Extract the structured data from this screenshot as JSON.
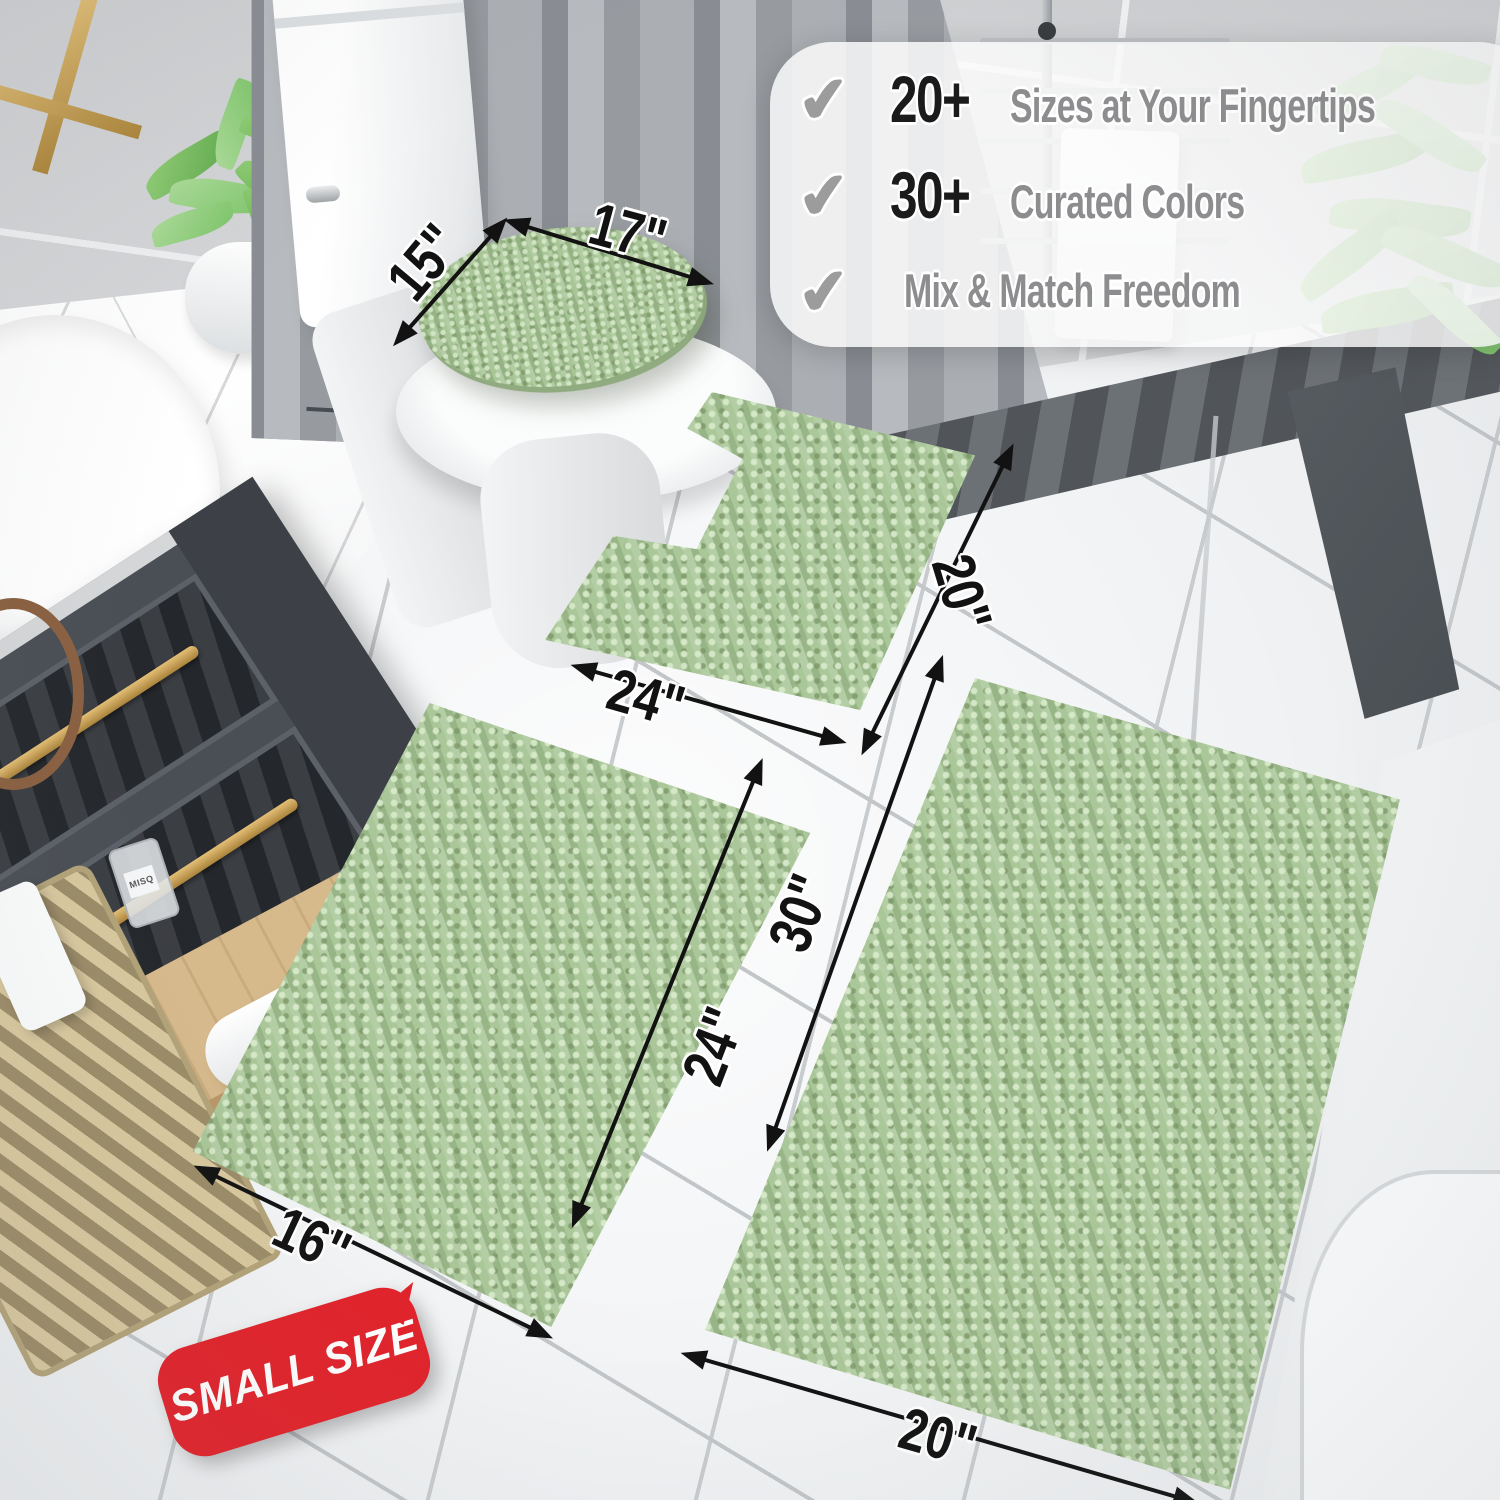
{
  "overlay": {
    "check_char": "✔",
    "features": [
      {
        "stat": "20+",
        "label": "Sizes at Your Fingertips"
      },
      {
        "stat": "30+",
        "label": "Curated Colors"
      },
      {
        "stat": "",
        "label": "Mix & Match Freedom"
      }
    ]
  },
  "dimensions": {
    "toilet_lid": {
      "width": "17\"",
      "depth": "15\""
    },
    "contour_rug": {
      "width": "24\"",
      "depth": "20\""
    },
    "small_rug": {
      "width": "16\"",
      "length": "24\""
    },
    "large_rug": {
      "width": "20\"",
      "length": "30\""
    }
  },
  "badge": {
    "label": "SMALL SIZE",
    "color": "#e2222a"
  },
  "decor": {
    "bottle_label": "MISQ"
  },
  "colors": {
    "rug_green": "#a6c494",
    "badge_red": "#e2222a",
    "stat_text": "#1b1b1b",
    "feature_text": "#8d8d8f",
    "floor": "#eef0f2",
    "wall_tile": "#d9dadc",
    "curtain": "#a3a7ac",
    "vanity": "#4a4e55",
    "gold_accent": "#c9a254"
  }
}
